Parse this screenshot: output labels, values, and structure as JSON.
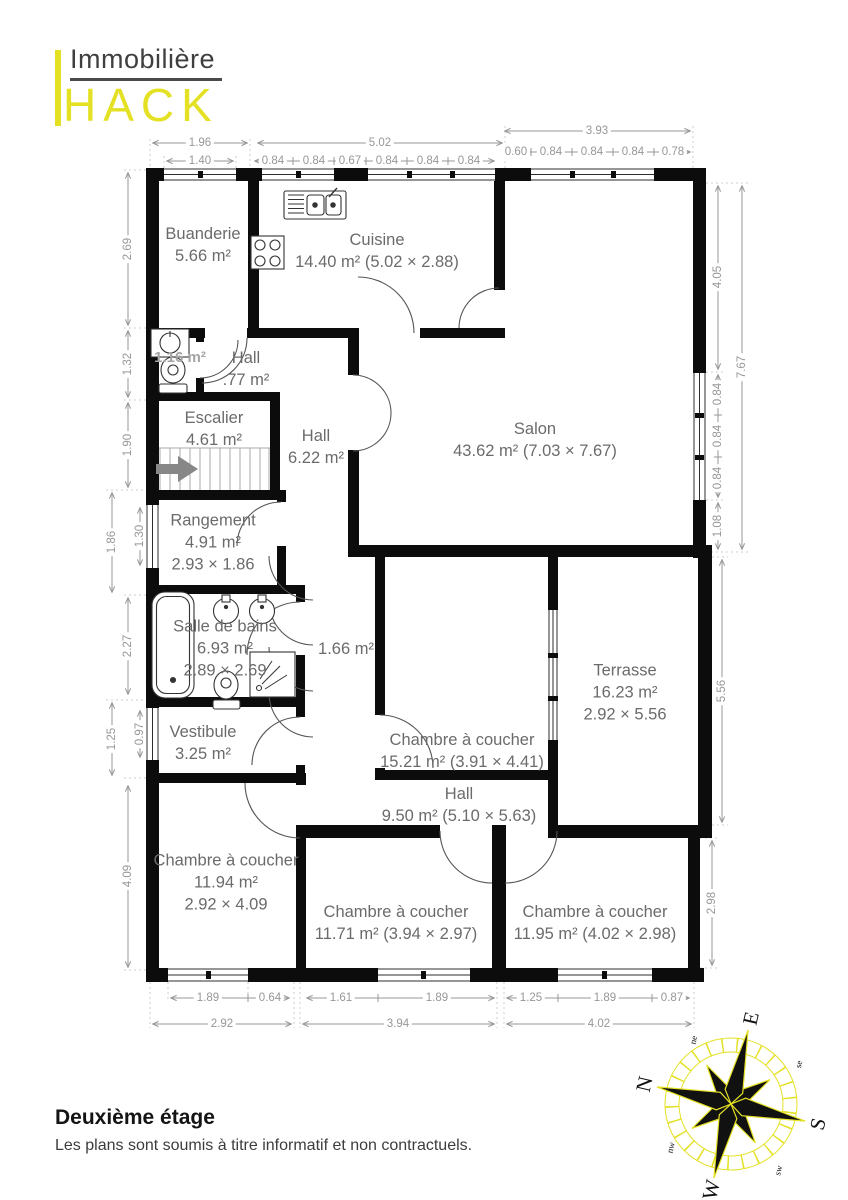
{
  "logo": {
    "line1": "Immobilière",
    "wordmark": "HACK"
  },
  "colors": {
    "accent_yellow": "#e4e125",
    "wall_black": "#0c0c0c",
    "room_label_gray": "#6b6b6b",
    "dim_gray": "#979797"
  },
  "rooms": [
    {
      "name": "Buanderie",
      "area": "5.66 m²"
    },
    {
      "name": "Cuisine",
      "area": "14.40 m² (5.02 × 2.88)"
    },
    {
      "area": "1.16 m²"
    },
    {
      "name": "Hall",
      "area": ".77 m²"
    },
    {
      "name": "Escalier",
      "area": "4.61 m²"
    },
    {
      "name": "Hall",
      "area": "6.22 m²"
    },
    {
      "name": "Salon",
      "area": "43.62 m² (7.03 × 7.67)"
    },
    {
      "name": "Rangement",
      "area": "4.91 m²",
      "size": "2.93 × 1.86"
    },
    {
      "name": "Salle de bains",
      "area": "6.93 m²",
      "size": "2.89 × 2.69"
    },
    {
      "area": "1.66 m²"
    },
    {
      "name": "Terrasse",
      "area": "16.23 m²",
      "size": "2.92 × 5.56"
    },
    {
      "name": "Vestibule",
      "area": "3.25 m²"
    },
    {
      "name": "Chambre à coucher",
      "area": "15.21 m² (3.91 × 4.41)"
    },
    {
      "name": "Hall",
      "area": "9.50 m² (5.10 × 5.63)"
    },
    {
      "name": "Chambre à coucher",
      "area": "11.94 m²",
      "size": "2.92 × 4.09"
    },
    {
      "name": "Chambre à coucher",
      "area": "11.71 m² (3.94 × 2.97)"
    },
    {
      "name": "Chambre à coucher",
      "area": "11.95 m² (4.02 × 2.98)"
    }
  ],
  "dims": {
    "top": [
      "1.96",
      "1.40",
      "5.02",
      "0.84",
      "0.84",
      "0.67",
      "0.84",
      "0.84",
      "0.84",
      "3.93",
      "0.60",
      "0.84",
      "0.84",
      "0.84",
      "0.78"
    ],
    "right": [
      "4.05",
      "0.84",
      "0.84",
      "0.84",
      "1.08",
      "7.67",
      "5.56",
      "2.98"
    ],
    "left": [
      "2.69",
      "1.32",
      "1.90",
      "1.86",
      "1.30",
      "2.27",
      "1.25",
      "0.97",
      "4.09"
    ],
    "bottom": [
      "1.89",
      "0.64",
      "1.61",
      "1.89",
      "1.25",
      "1.89",
      "0.87",
      "2.92",
      "3.94",
      "4.02"
    ]
  },
  "compass": {
    "cardinal": [
      "N",
      "E",
      "S",
      "W"
    ],
    "intercardinal": [
      "ne",
      "se",
      "sw",
      "nw"
    ]
  },
  "footer": {
    "title": "Deuxième étage",
    "disclaimer": "Les plans sont soumis à titre informatif et non contractuels."
  }
}
